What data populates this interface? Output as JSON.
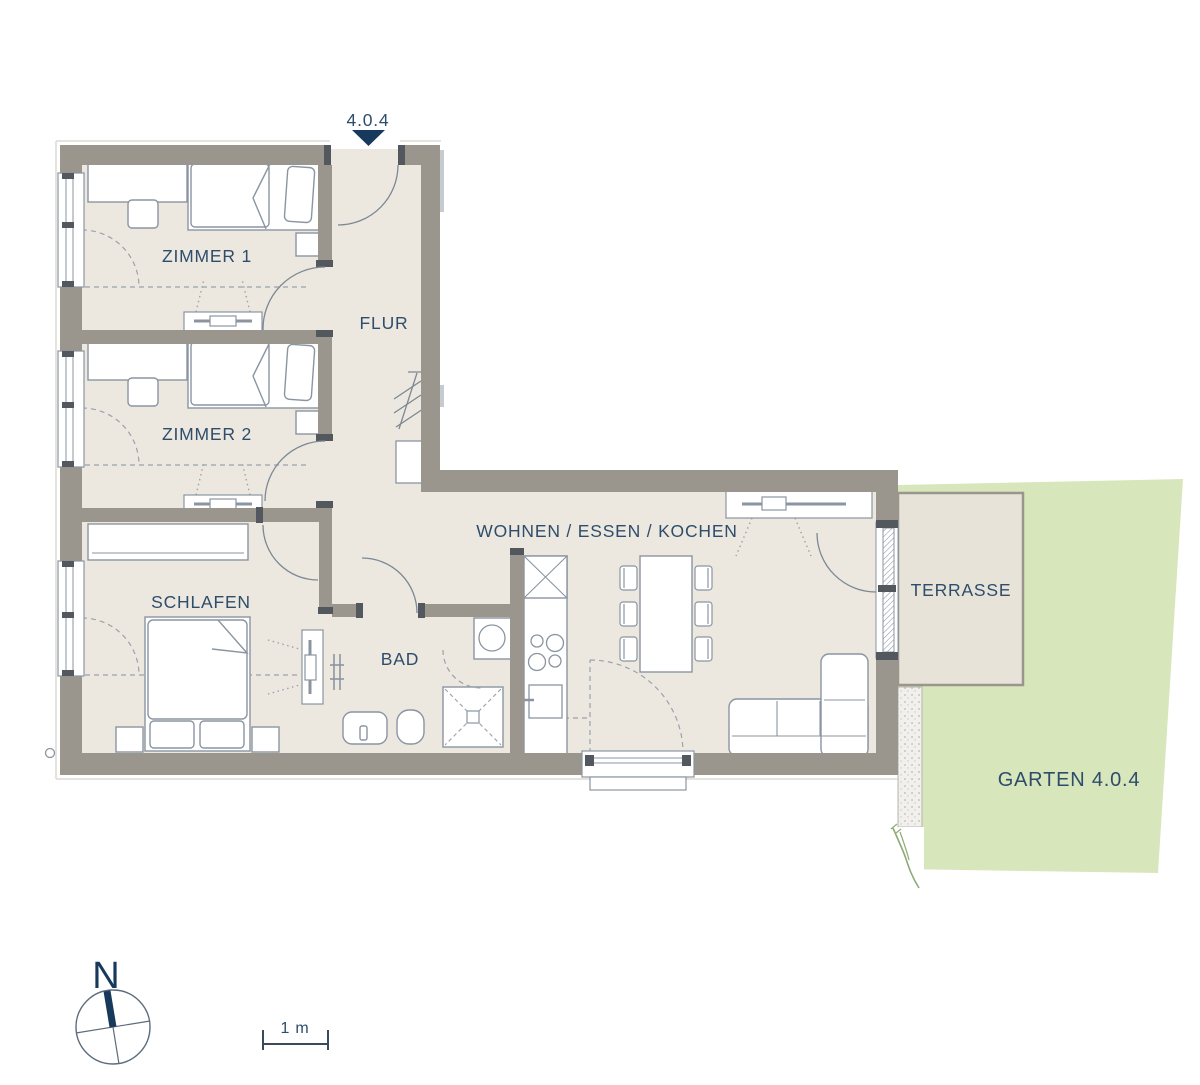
{
  "unit": {
    "number": "4.0.4"
  },
  "labels": {
    "entrance_unit": "4.0.4",
    "zimmer1": "ZIMMER 1",
    "zimmer2": "ZIMMER 2",
    "flur": "FLUR",
    "schlafen": "SCHLAFEN",
    "bad": "BAD",
    "wohnen": "WOHNEN / ESSEN / KOCHEN",
    "terrasse": "TERRASSE",
    "garten": "GARTEN 4.0.4",
    "compass_north": "N",
    "scale_bar": "1 m"
  },
  "icons": {
    "entrance_marker": "triangle-down-entrance-arrow",
    "compass": "north-compass-rose"
  },
  "colors": {
    "wall": "#9a958d",
    "wall_cap": "#53585f",
    "floor": "#ece8e0",
    "terrace": "#e7e3d9",
    "garden": "#d8e6bc",
    "gravel": "#f1f0ec",
    "label_text": "#2d4d6b",
    "navy_accent": "#17395c",
    "furniture_stroke": "#8a95a1",
    "dashed_lines": "#9aa2ab"
  }
}
